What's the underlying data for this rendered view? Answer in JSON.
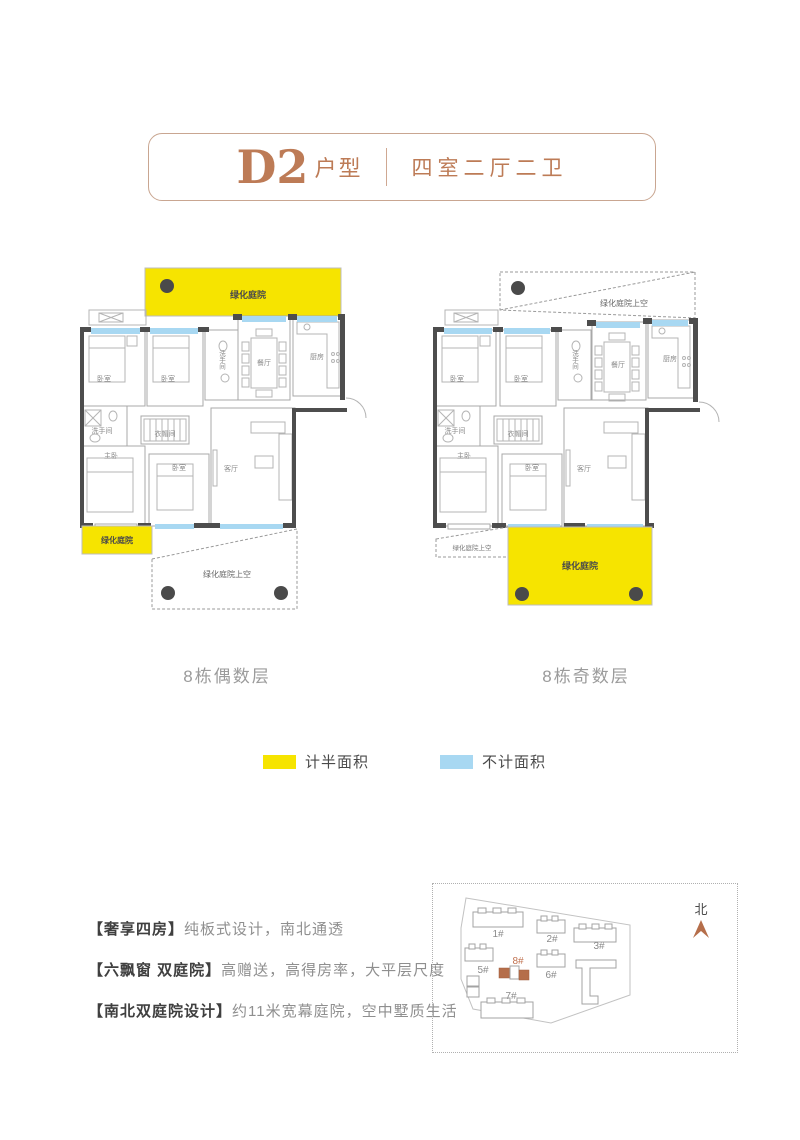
{
  "title": {
    "code": "D2",
    "suffix": "户型",
    "layout": "四室二厅二卫"
  },
  "plans": {
    "left": {
      "caption": "8栋偶数层",
      "courtyard_top_label": "绿化庭院",
      "courtyard_bottom_label": "绿化庭院",
      "sky_bottom_label": "绿化庭院上空",
      "rooms": {
        "bedroom_a": "卧室",
        "bedroom_b": "卧室",
        "bath_a": "洗手间",
        "dining": "餐厅",
        "kitchen": "厨房",
        "bath_b": "洗手间",
        "closet": "衣帽间",
        "master": "主卧",
        "bedroom_c": "卧室",
        "living": "客厅"
      }
    },
    "right": {
      "caption": "8栋奇数层",
      "sky_top_label": "绿化庭院上空",
      "sky_bottom_label": "绿化庭院上空",
      "courtyard_label": "绿化庭院",
      "rooms": {
        "bedroom_a": "卧室",
        "bedroom_b": "卧室",
        "bath_a": "洗手间",
        "dining": "餐厅",
        "kitchen": "厨房",
        "bath_b": "洗手间",
        "closet": "衣帽间",
        "master": "主卧",
        "bedroom_c": "卧室",
        "living": "客厅"
      }
    }
  },
  "legend": {
    "half_label": "计半面积",
    "half_color": "#f6e400",
    "excluded_label": "不计面积",
    "excluded_color": "#a8d8f2"
  },
  "features": [
    {
      "tag": "【奢享四房】",
      "desc": "纯板式设计，南北通透"
    },
    {
      "tag": "【六飘窗 双庭院】",
      "desc": "高赠送，高得房率，大平层尺度"
    },
    {
      "tag": "【南北双庭院设计】",
      "desc": "约11米宽幕庭院，空中墅质生活"
    }
  ],
  "sitemap": {
    "north_label": "北",
    "buildings": [
      {
        "label": "1#"
      },
      {
        "label": "2#"
      },
      {
        "label": "3#"
      },
      {
        "label": "5#"
      },
      {
        "label": "6#"
      },
      {
        "label": "7#"
      },
      {
        "label": "8#"
      }
    ]
  }
}
